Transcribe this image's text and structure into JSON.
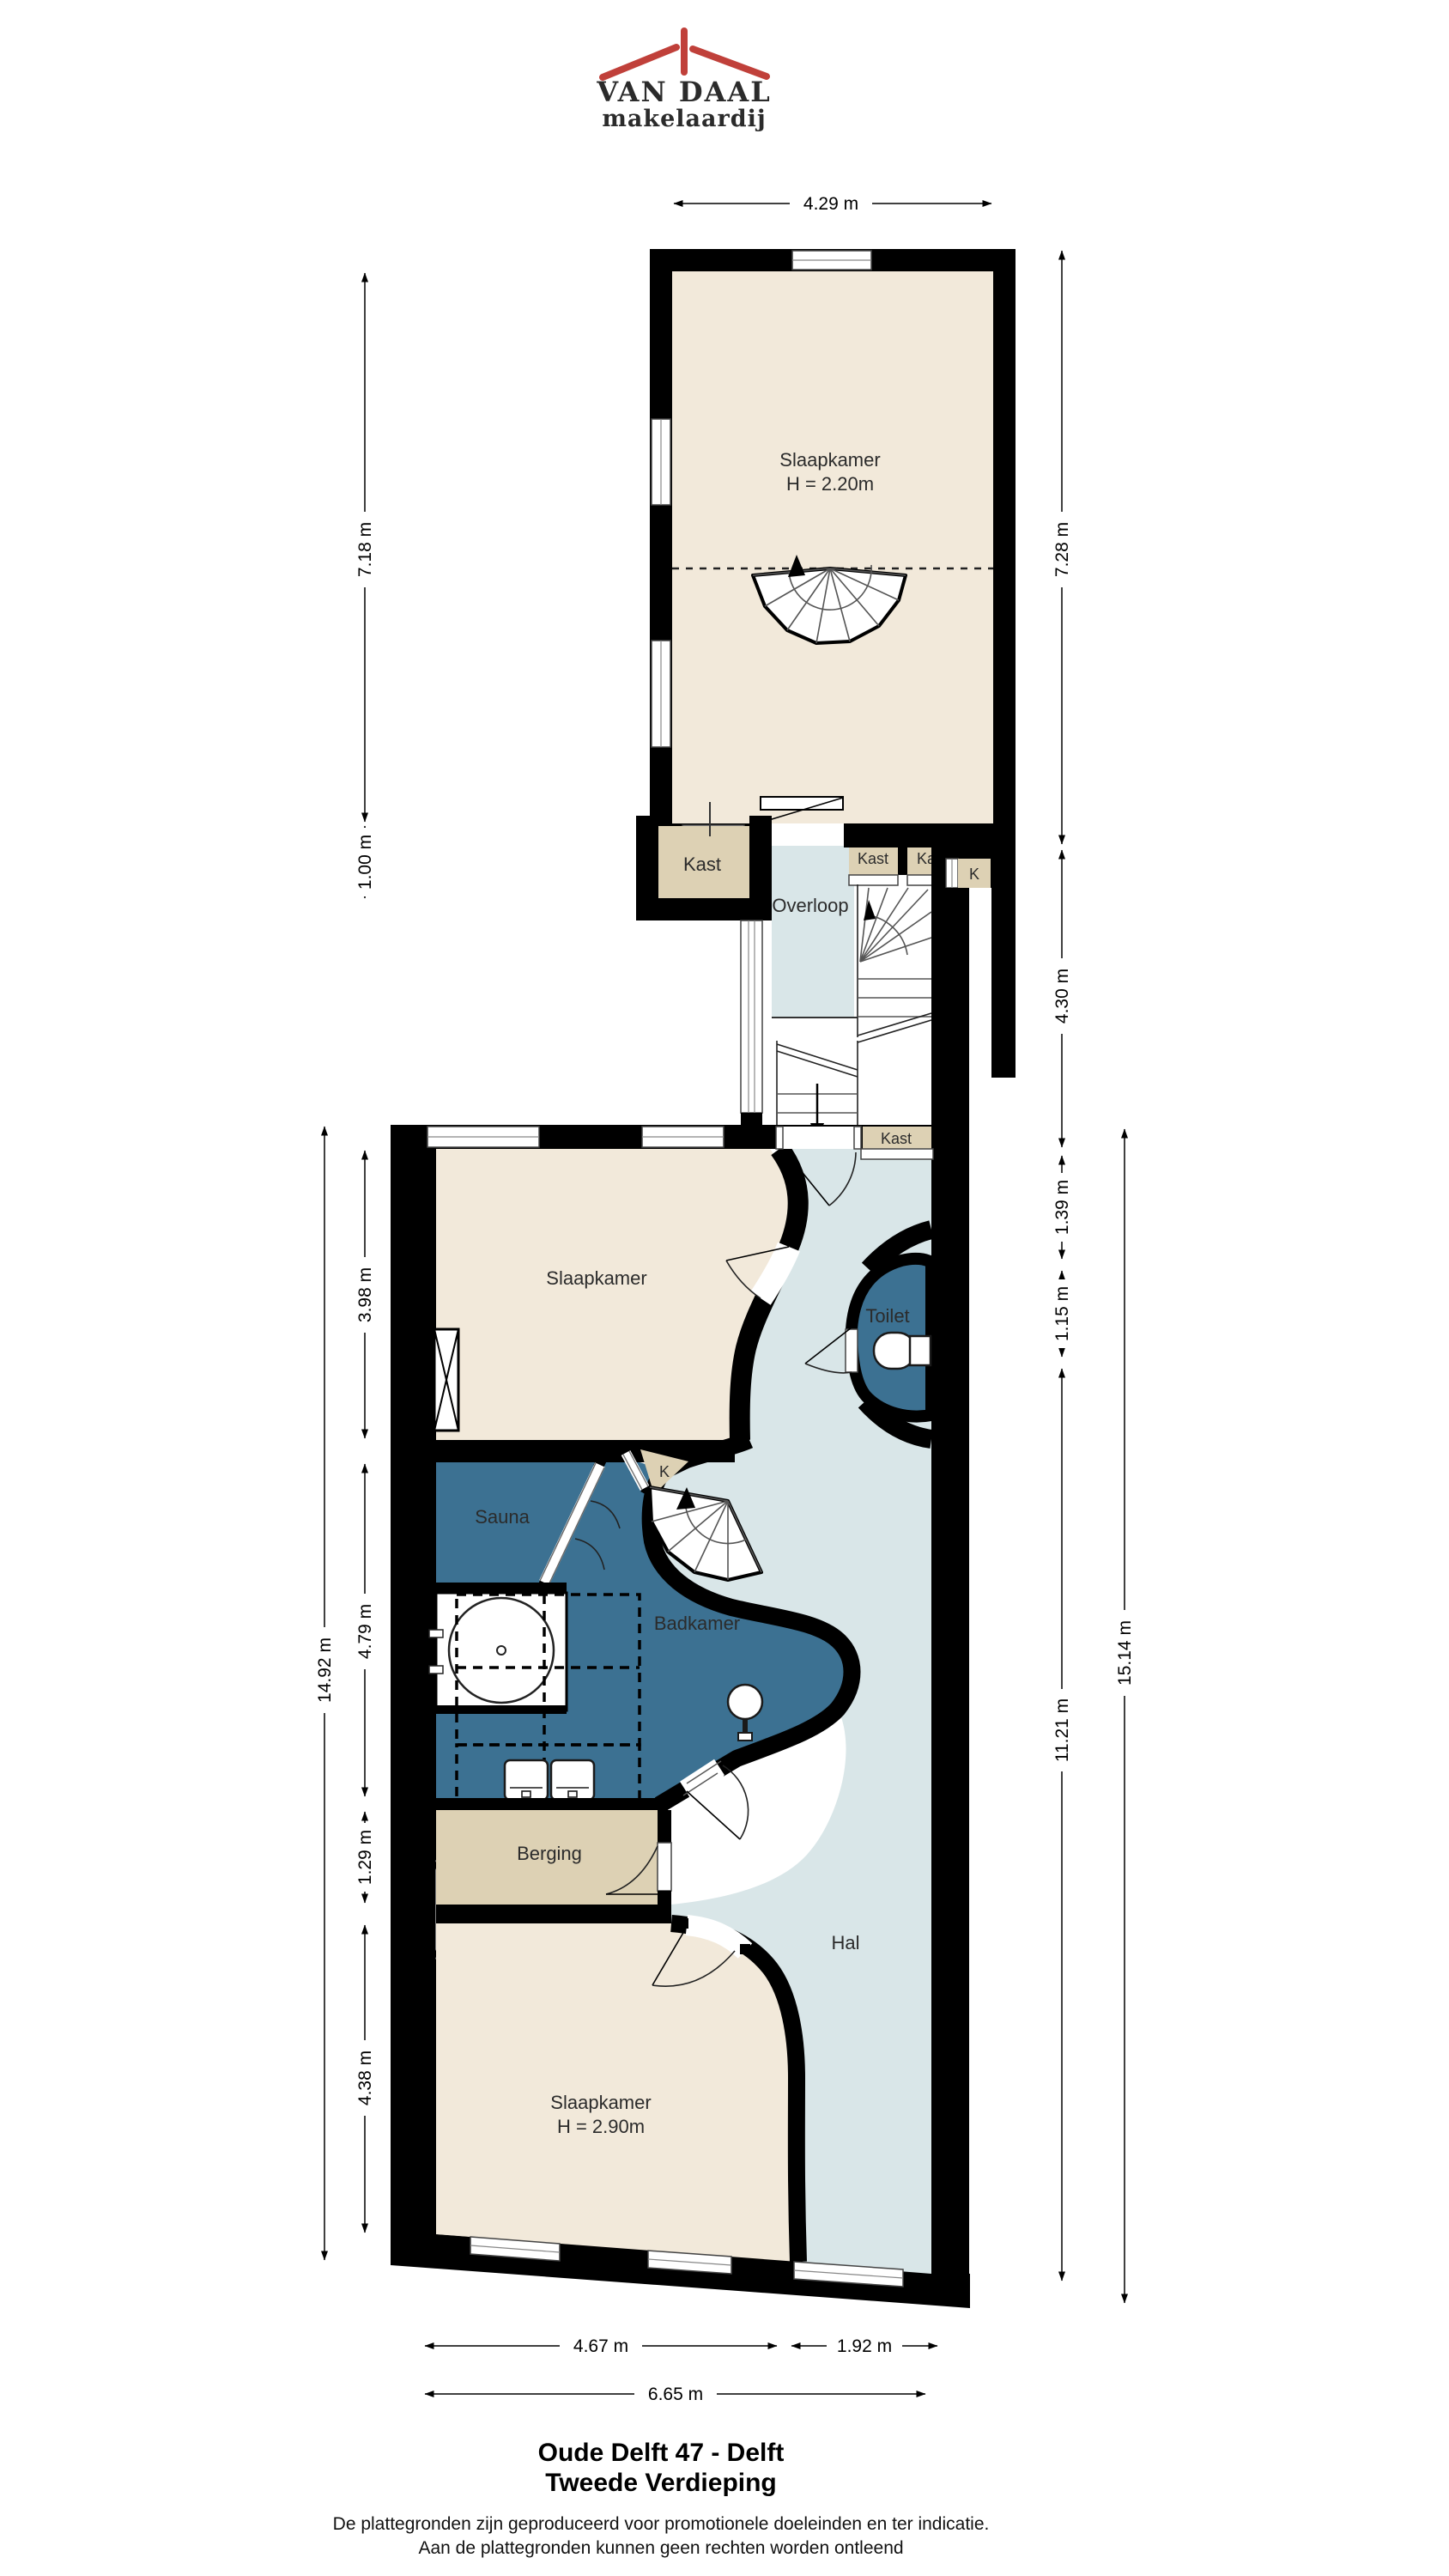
{
  "logo": {
    "line1": "VAN DAAL",
    "line2": "makelaardij"
  },
  "rooms": {
    "bedroom_top": {
      "label": "Slaapkamer",
      "height": "H = 2.20m"
    },
    "kast_top": {
      "label": "Kast"
    },
    "overloop": {
      "label": "Overloop"
    },
    "kast_a": {
      "label": "Kast"
    },
    "kast_b": {
      "label": "Kast"
    },
    "kast_k_top": {
      "label": "K"
    },
    "kast_stair": {
      "label": "Kast"
    },
    "bedroom_mid": {
      "label": "Slaapkamer"
    },
    "toilet": {
      "label": "Toilet"
    },
    "sauna": {
      "label": "Sauna"
    },
    "kast_k_mid": {
      "label": "K"
    },
    "bathroom": {
      "label": "Badkamer"
    },
    "storage": {
      "label": "Berging"
    },
    "hall": {
      "label": "Hal"
    },
    "bedroom_bottom": {
      "label": "Slaapkamer",
      "height": "H = 2.90m"
    }
  },
  "dims": {
    "top": "4.29 m",
    "left": {
      "room_top": "7.18 m",
      "kast": "1.00 m",
      "bedroom_mid": "3.98 m",
      "bathroom": "4.79 m",
      "total": "14.92 m",
      "storage": "1.29 m",
      "bedroom_bottom": "4.38 m"
    },
    "right": {
      "room_top": "7.28 m",
      "stairs": "4.30 m",
      "kast": "1.39 m",
      "toilet": "1.15 m",
      "total": "15.14 m",
      "hall": "11.21 m"
    },
    "bottom": {
      "bedroom": "4.67 m",
      "hall": "1.92 m",
      "total": "6.65 m"
    }
  },
  "footer": {
    "title1": "Oude Delft 47 - Delft",
    "title2": "Tweede Verdieping",
    "disclaimer1": "De plattegronden zijn geproduceerd voor promotionele doeleinden en ter indicatie.",
    "disclaimer2": "Aan de plattegronden kunnen geen rechten worden ontleend"
  },
  "colors": {
    "wall": "#000000",
    "room_cream": "#f2e9da",
    "closet_tan": "#ddd1b4",
    "hall_blue": "#d9e6e8",
    "wet_blue": "#3c7192",
    "logo_navy": "#2e4e7e",
    "logo_red": "#c0403a"
  }
}
